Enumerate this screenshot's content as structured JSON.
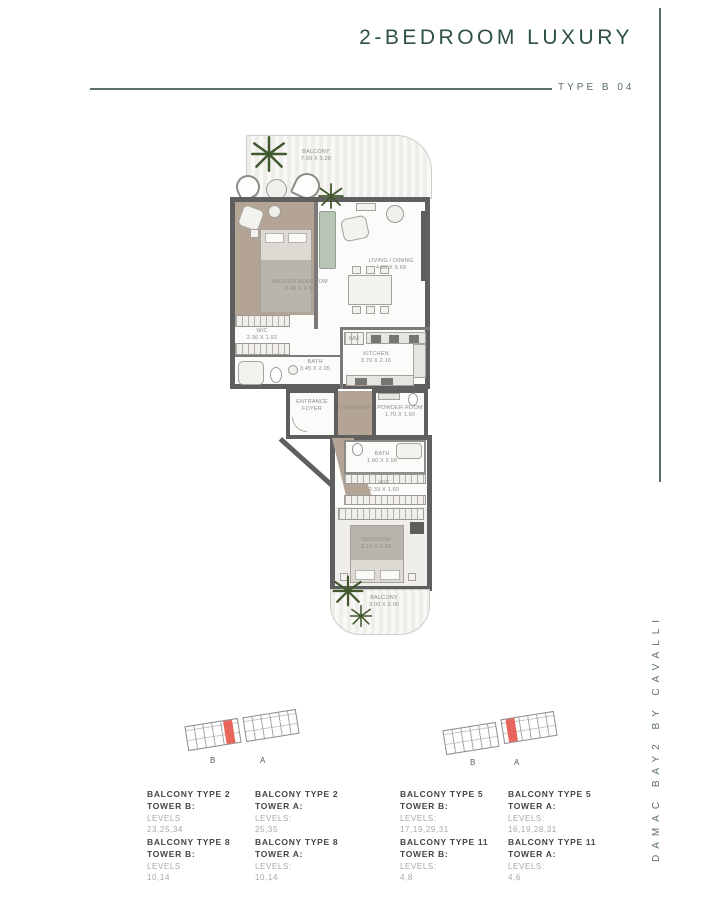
{
  "header": {
    "title": "2-BEDROOM LUXURY",
    "type_label": "TYPE B 04"
  },
  "brand_vertical": "DAMAC BAY2 BY CAVALLI",
  "rooms": {
    "balcony_top": {
      "name": "BALCONY",
      "dims": "7.00 X 3.28"
    },
    "master_bedroom": {
      "name": "MASTER BEDROOM",
      "dims": "3.40 X 4.54"
    },
    "wic_master": {
      "name": "W/C",
      "dims": "2.36 X 1.92"
    },
    "bath_master": {
      "name": "BATH",
      "dims": "3.45 X 2.05"
    },
    "living_dining": {
      "name": "LIVING / DINING",
      "dims": "4.00 X 5.68"
    },
    "kitchen": {
      "name": "KITCHEN",
      "dims": "3.70 X 2.16"
    },
    "wm": {
      "name": "WM"
    },
    "entrance_foyer": {
      "name": "ENTRANCE FOYER"
    },
    "corridor": {
      "name": "CORRIDOR"
    },
    "powder_room": {
      "name": "POWDER ROOM",
      "dims": "1.70 X 1.60"
    },
    "bath_2": {
      "name": "BATH",
      "dims": "1.60 X 2.58"
    },
    "wic_2": {
      "name": "W/C",
      "dims": "2.33 X 1.60"
    },
    "bedroom_2": {
      "name": "BEDROOM",
      "dims": "3.10 X 3.52"
    },
    "balcony_bottom": {
      "name": "BALCONY",
      "dims": "3.00 X 2.00"
    }
  },
  "keyplans": [
    {
      "tower_left_label": "B",
      "tower_right_label": "A",
      "highlighted_tower": "B"
    },
    {
      "tower_left_label": "B",
      "tower_right_label": "A",
      "highlighted_tower": "A"
    }
  ],
  "legend": {
    "items": [
      {
        "type": "BALCONY TYPE 2",
        "tower": "TOWER B:",
        "levels_label": "LEVELS:",
        "levels": "23,25,34"
      },
      {
        "type": "BALCONY TYPE 2",
        "tower": "TOWER A:",
        "levels_label": "LEVELS:",
        "levels": "25,35"
      },
      {
        "type": "BALCONY TYPE 5",
        "tower": "TOWER B:",
        "levels_label": "LEVELS:",
        "levels": "17,19,29,31"
      },
      {
        "type": "BALCONY TYPE 5",
        "tower": "TOWER A:",
        "levels_label": "LEVELS:",
        "levels": "16,19,28,31"
      },
      {
        "type": "BALCONY TYPE 8",
        "tower": "TOWER B:",
        "levels_label": "LEVELS:",
        "levels": "10,14"
      },
      {
        "type": "BALCONY TYPE 8",
        "tower": "TOWER A:",
        "levels_label": "LEVELS:",
        "levels": "10,14"
      },
      {
        "type": "BALCONY TYPE 11",
        "tower": "TOWER B:",
        "levels_label": "LEVELS:",
        "levels": "4,8"
      },
      {
        "type": "BALCONY TYPE 11",
        "tower": "TOWER A:",
        "levels_label": "LEVELS:",
        "levels": "4,6"
      }
    ]
  },
  "colors": {
    "title_color": "#2f5044",
    "rule_color": "#5a7066",
    "wall_color": "#5f5f5f",
    "taupe": "#b3a495",
    "plant_green": "#41582f",
    "highlight_red": "#e8655c",
    "legend_dark": "#454545",
    "legend_muted": "#a9a7a5"
  }
}
